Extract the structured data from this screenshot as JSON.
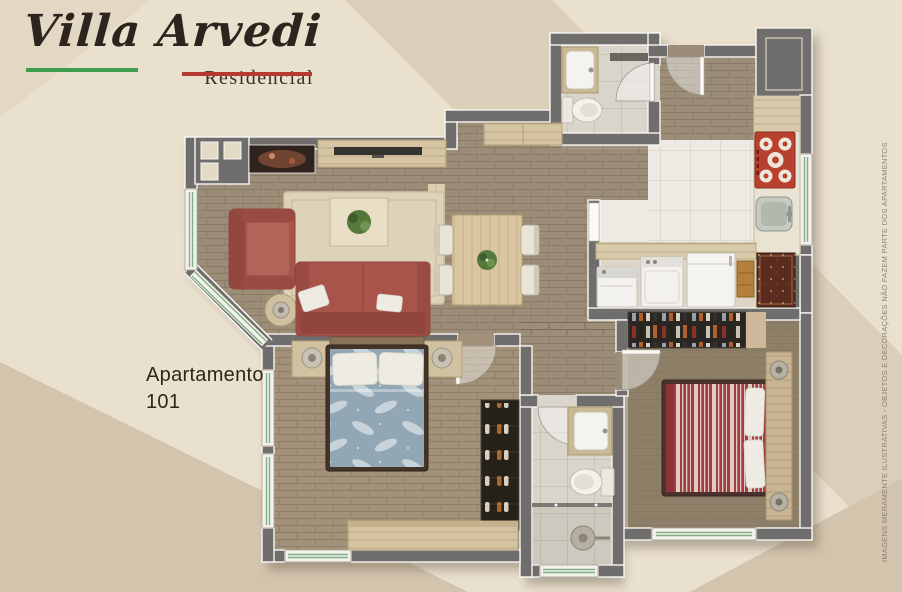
{
  "brand": {
    "title_word1": "Villa",
    "title_word2": "Arvedi",
    "subtitle": "Residencial"
  },
  "apartment": {
    "line1": "Apartamento",
    "line2": "101"
  },
  "disclaimer": "IMAGENS MERAMENTE ILUSTRATIVAS - OBJETOS E DECORAÇÕES NÃO FAZEM PARTE DOS APARTAMENTOS",
  "colors": {
    "background": "#e9e0cd",
    "background_band": "#dbcfb9",
    "background_band2": "#d3c5ad",
    "wall": "#6f6e6c",
    "sofa_red": "#a8544a",
    "bed_red": "#a23d42",
    "bed_blue": "#91a7b6",
    "stove_red": "#b8402f",
    "wood_light": "#d6c5a3",
    "floor_social": "#9c8d79",
    "floor_kitchen": "#eceae2",
    "floor_bath": "#d9d5cb",
    "floor_blue": "#a39179",
    "floor_red": "#8e8068",
    "closet_dark": "#2a2622",
    "underline_green": "#3f9e4d",
    "underline_red": "#b53a31",
    "window_glass": "#7fae87",
    "logo_text": "#2d251d",
    "label_text": "#2f2619",
    "disclaimer_text": "#8d8170",
    "rug_service": "#5a2b1e",
    "appliance_white": "#f2f1ed",
    "plant_green": "#567a3c",
    "rug_living": "#ded3b9"
  },
  "floorplan": {
    "rooms": [
      "living-room",
      "dining-room",
      "kitchen",
      "laundry-area",
      "entry-hall",
      "bathroom-social",
      "bathroom-suite",
      "bedroom-blue",
      "bedroom-red",
      "hallway",
      "wardrobe-clothes",
      "shoe-closet"
    ],
    "furniture": [
      "red-sofa",
      "red-armchair",
      "coffee-table-with-plant",
      "side-table-lamp",
      "tv-console",
      "wall-art",
      "corner-niches",
      "dining-table-with-plant",
      "dining-chairs",
      "sideboard",
      "stove",
      "kitchen-sink",
      "kitchen-counter",
      "washer",
      "dryer",
      "freezer",
      "service-rug",
      "double-bed-blue",
      "double-bed-red",
      "nightstands-with-lamps",
      "desk-dresser",
      "headboard-panel-lamps",
      "toilet",
      "vanity-sink",
      "shower",
      "glass-partition",
      "windows",
      "doors"
    ]
  }
}
